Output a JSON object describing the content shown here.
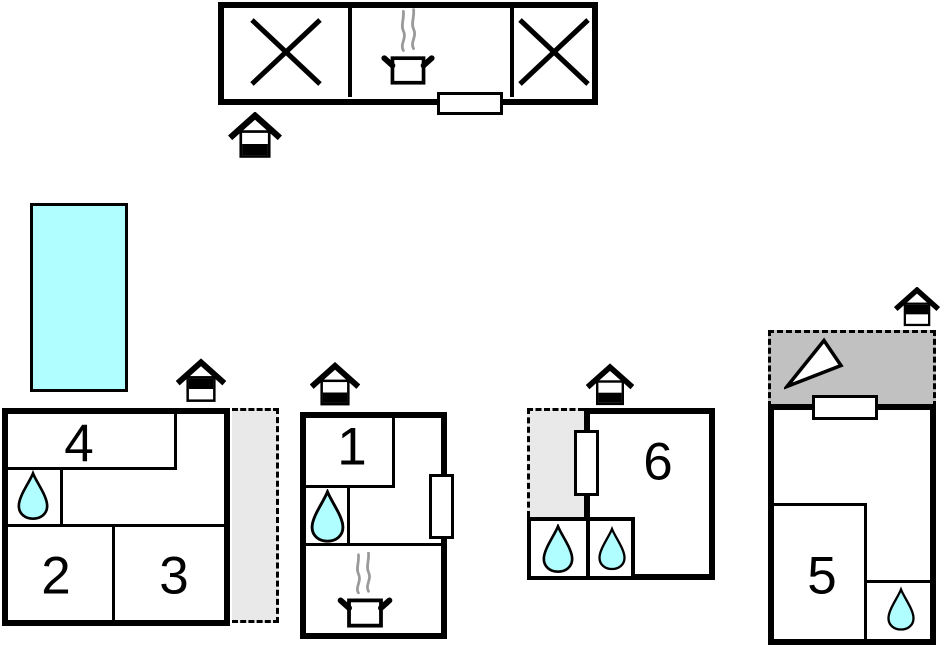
{
  "floorplan": {
    "room_labels": {
      "room1": "1",
      "room2": "2",
      "room3": "3",
      "room4": "4",
      "room5": "5",
      "room6": "6"
    },
    "icon_names": {
      "entrance": "house-entrance-icon",
      "water_point": "water-drop-icon",
      "stove": "steaming-pot-icon",
      "unavailable_room": "cross-icon",
      "terrace_marker": "triangle-icon",
      "door": "door-opening",
      "window": "window-opening"
    },
    "colors": {
      "water": "#b0feff",
      "pool": "#b0feff",
      "terrace_dark": "#c1c1c1",
      "courtyard_light": "#e9e9e9",
      "wall": "#000000",
      "steam": "#9a9a9a"
    }
  }
}
